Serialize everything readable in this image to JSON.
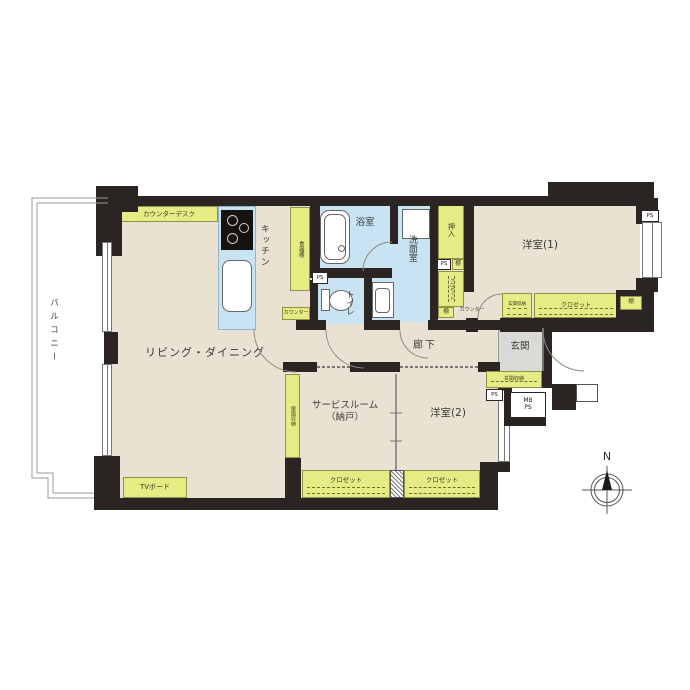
{
  "colors": {
    "wall": "#2a2422",
    "floor": "#e9e2d2",
    "wet": "#c8e3f1",
    "storage": "#e6eb84",
    "entrance": "#d9d9d5"
  },
  "rooms": {
    "balcony": "バルコニー",
    "living_dining": "リビング・ダイニング",
    "kitchen": "キッチン",
    "bath": "浴室",
    "washroom": "洗面室",
    "toilet": "トイレ",
    "hallway": "廊下",
    "entrance": "玄関",
    "western_room_1": "洋室(1)",
    "western_room_2": "洋室(2)",
    "service_room_line1": "サービスルーム",
    "service_room_line2": "（納戸）"
  },
  "storage": {
    "counter_desk": "カウンターデスク",
    "dish_shelf": "食器棚",
    "kitchen_counter": "カウンター",
    "entrance_counter": "カウンター",
    "oshiire": "押入",
    "closet_column": "クロゼット",
    "closet_room1": "クロゼット",
    "closet_service": "クロゼット",
    "closet_room2": "クロゼット",
    "shelf_1": "棚",
    "shelf_2": "棚",
    "shelf_3": "棚",
    "genkan_storage_upper": "玄関収納",
    "genkan_storage_lower": "玄関収納",
    "wall_storage": "壁面収納",
    "tv_board": "TVボード"
  },
  "utility": {
    "ps_toilet": "PS",
    "ps_column": "PS",
    "ps_room1": "PS",
    "ps_entrance": "PS",
    "mb_line1": "MB",
    "mb_line2": "PS"
  },
  "compass": {
    "north": "N"
  }
}
